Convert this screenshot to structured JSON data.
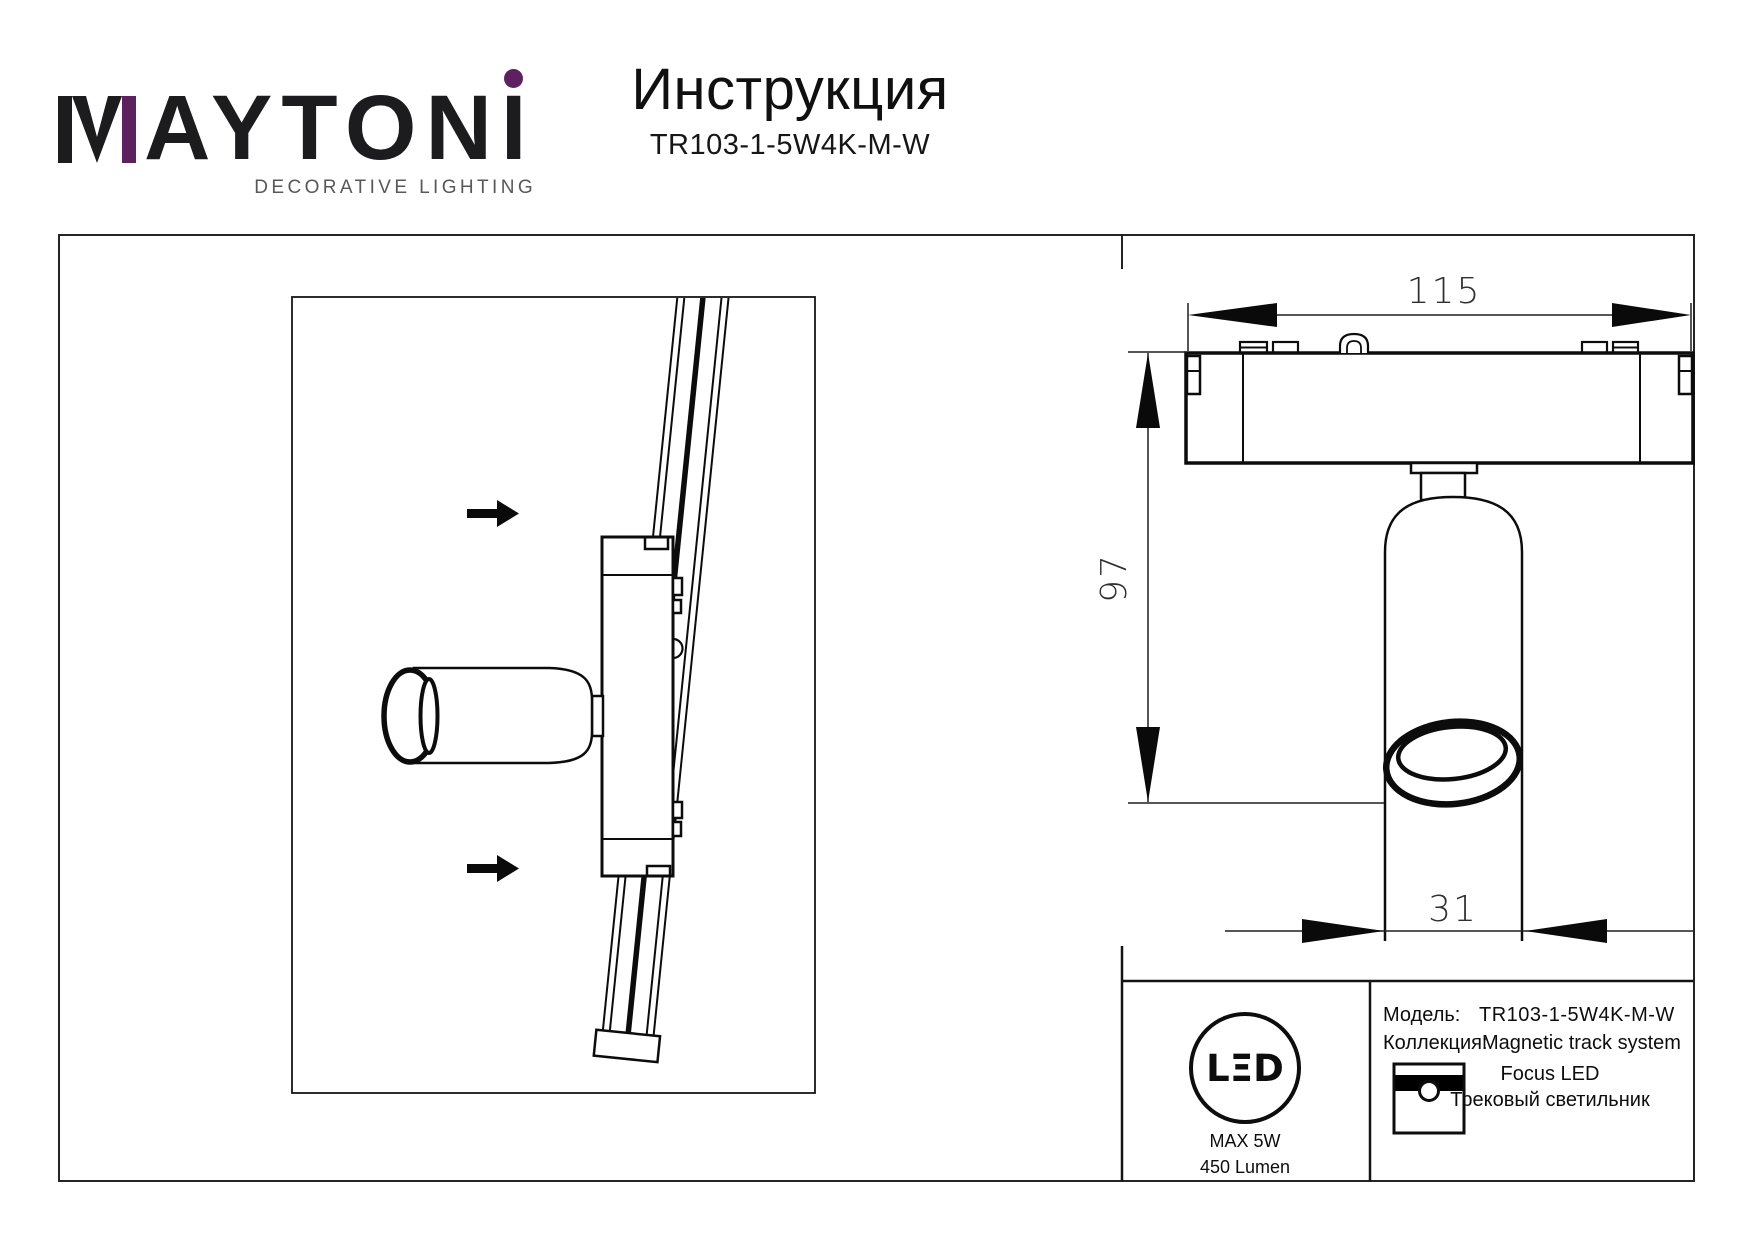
{
  "header": {
    "logo": {
      "rest": "AYTON",
      "last": "I",
      "tagline": "DECORATIVE LIGHTING"
    },
    "title": "Инструкция",
    "model": "TR103-1-5W4K-M-W"
  },
  "dimensions": {
    "width": "115",
    "height": "97",
    "diameter": "31"
  },
  "info": {
    "model_label": "Модель:",
    "model_value": "TR103-1-5W4K-M-W",
    "collection_label": "Коллекция:",
    "collection_value": "Magnetic track system",
    "line_name": "Focus LED",
    "type_name": "Трековый светильник",
    "led": {
      "logo": "LΞD",
      "max_power": "MAX 5W",
      "luminous_flux": "450 Lumen"
    }
  },
  "colors": {
    "accent": "#5e2160",
    "ink": "#1c1b1d",
    "gray": "#58585a"
  }
}
